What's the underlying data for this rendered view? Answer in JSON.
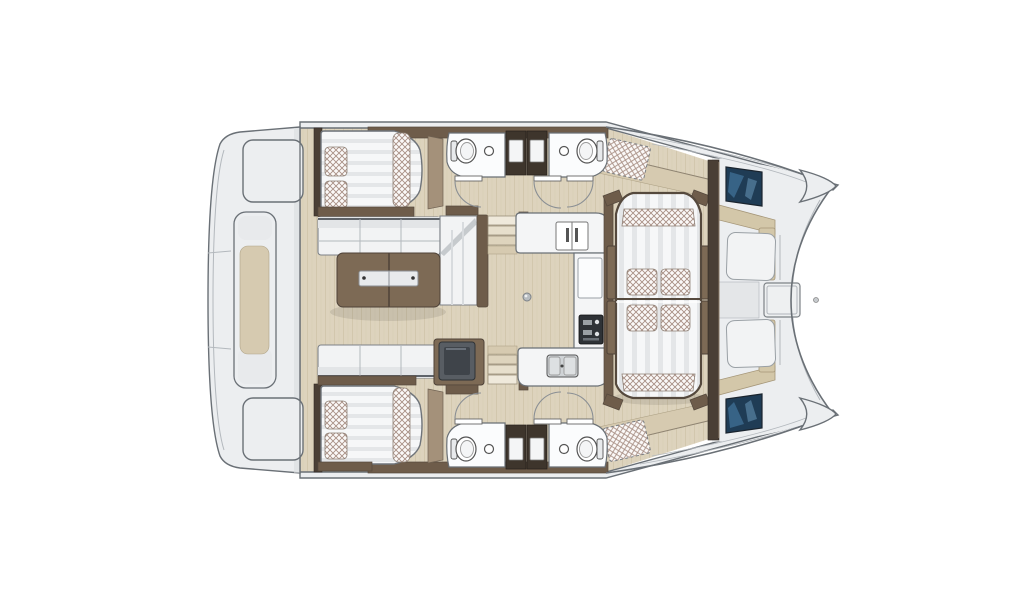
{
  "title": "Catamaran interior layout plan (top view)",
  "view": "top-down floor plan, bow to the right, no visible text labels",
  "palette": {
    "pageBg": "#ffffff",
    "line": "#6a7076",
    "lightline": "#b3b8bd",
    "deck": "#eceef0",
    "deckShade": "#d9dcdf",
    "floorTan": "#ddd3bd",
    "floorGrain": "#d2c7ad",
    "walkTan": "#d6cab0",
    "seatTan": "#d3c7a9",
    "brownDark": "#4a3f35",
    "brownMid": "#6e5c4a",
    "brownLight": "#a4917a",
    "brownTable": "#7d6a55",
    "espresso": "#3e352c",
    "mattress": "#f6f7f8",
    "mattressStripe": "#e4e6e8",
    "hatch": "#a88f84",
    "hatchBg": "#fbf9f8",
    "navy": "#1f3c55",
    "navy2": "#3c6a8f",
    "appliance": "#585d63",
    "applianceDark": "#3f444a",
    "counter": "#f4f5f6",
    "sink": "#cfd3d6",
    "stove": "#2e3236"
  },
  "features": [
    {
      "name": "hull-outline",
      "label": "catamaran hull outline with twin bows at right"
    },
    {
      "name": "aft-platform",
      "label": "left platform deck with lockers"
    },
    {
      "name": "deck-locker-upper",
      "label": "upper deck locker hatch"
    },
    {
      "name": "deck-locker-lower",
      "label": "lower deck locker hatch"
    },
    {
      "name": "deck-console",
      "label": "center deck console with inset"
    },
    {
      "name": "cabin-upper-berth",
      "label": "upper double berth with pillows and runner"
    },
    {
      "name": "cabin-lower-berth",
      "label": "lower double berth with pillows and runner"
    },
    {
      "name": "saloon-sofa",
      "label": "L-shaped saloon sofa"
    },
    {
      "name": "saloon-table",
      "label": "wooden saloon table with metal strip"
    },
    {
      "name": "head-upper-left",
      "label": "upper bathroom with toilet and basin"
    },
    {
      "name": "head-upper-right",
      "label": "upper bathroom with toilet and basin"
    },
    {
      "name": "head-lower-left",
      "label": "lower bathroom with toilet and basin"
    },
    {
      "name": "head-lower-right",
      "label": "lower bathroom with toilet and basin"
    },
    {
      "name": "wardrobe-cabinets",
      "label": "dark wardrobe cabinets between bathrooms"
    },
    {
      "name": "companionway-upper",
      "label": "upper companionway steps"
    },
    {
      "name": "companionway-lower",
      "label": "lower companionway steps"
    },
    {
      "name": "galley-top-counter",
      "label": "galley counter with appliance"
    },
    {
      "name": "galley-side-counter",
      "label": "galley side counter with stove"
    },
    {
      "name": "galley-bottom-counter",
      "label": "galley counter with double sink"
    },
    {
      "name": "nav-appliance",
      "label": "grey appliance module beside lower sofa"
    },
    {
      "name": "center-sunbed",
      "label": "large central lounge sunbed with cushions"
    },
    {
      "name": "cockpit-seats",
      "label": "forward cockpit facing seats"
    },
    {
      "name": "cockpit-table",
      "label": "forward cockpit table"
    },
    {
      "name": "hull-hatch-upper",
      "label": "dark glass deck hatch, upper hull"
    },
    {
      "name": "hull-hatch-lower",
      "label": "dark glass deck hatch, lower hull"
    },
    {
      "name": "side-deck-upper",
      "label": "upper side deck walkway"
    },
    {
      "name": "side-deck-lower",
      "label": "lower side deck walkway"
    },
    {
      "name": "sunpad-upper",
      "label": "dashed optional sunpad, upper side deck"
    },
    {
      "name": "sunpad-lower",
      "label": "dashed optional sunpad, lower side deck"
    },
    {
      "name": "doors",
      "label": "cabin and bathroom door swings"
    }
  ]
}
